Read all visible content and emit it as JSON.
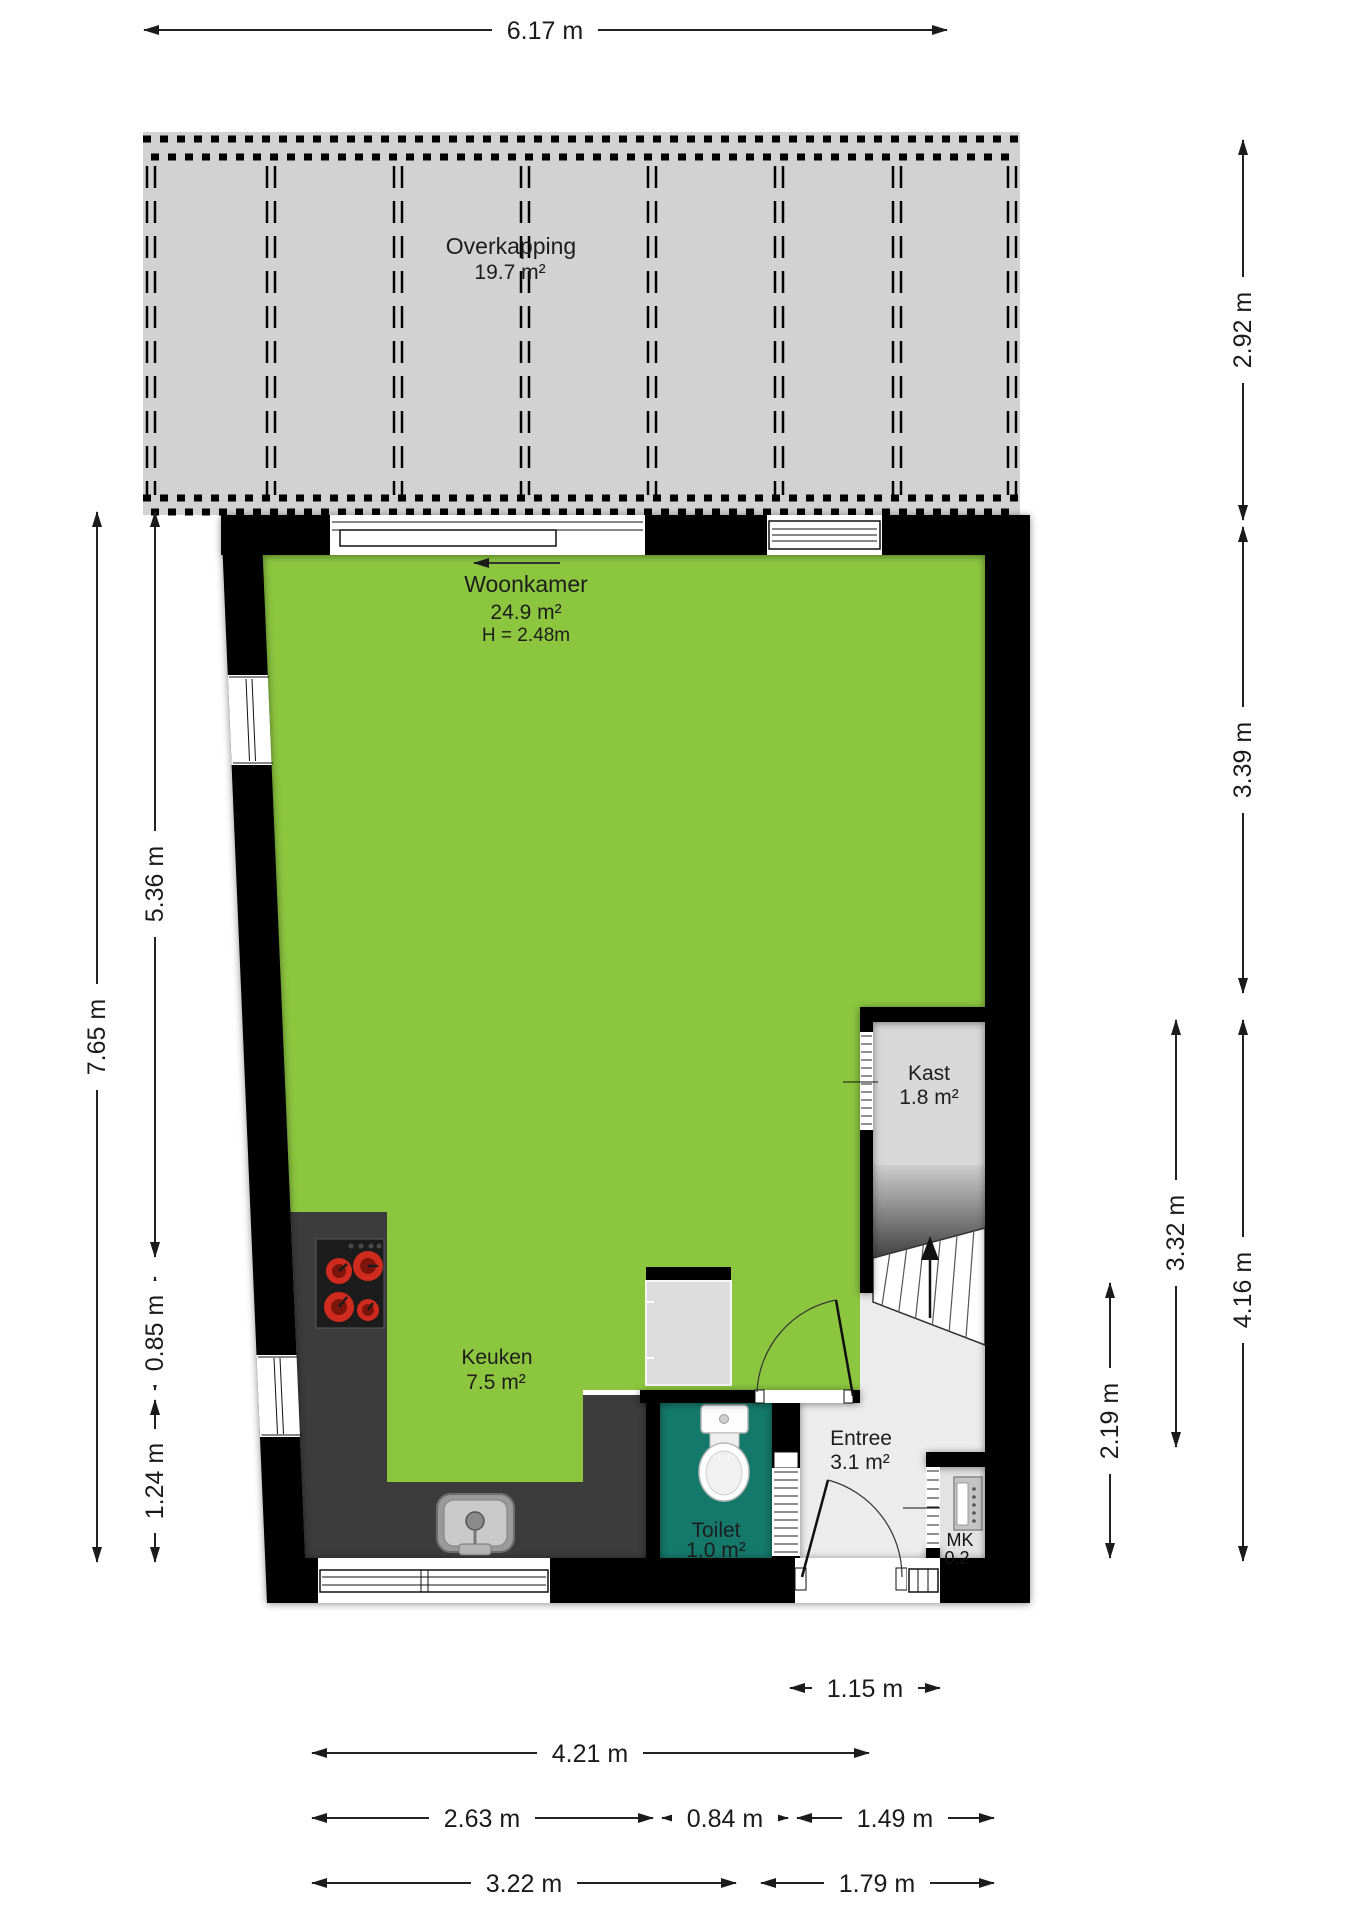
{
  "rooms": {
    "overkapping": {
      "label": "Overkapping",
      "area": "19.7 m²"
    },
    "woonkamer": {
      "label": "Woonkamer",
      "area": "24.9 m²",
      "height": "H = 2.48m"
    },
    "kast": {
      "label": "Kast",
      "area": "1.8 m²"
    },
    "keuken": {
      "label": "Keuken",
      "area": "7.5 m²"
    },
    "toilet": {
      "label": "Toilet",
      "area": "1.0 m²"
    },
    "entree": {
      "label": "Entree",
      "area": "3.1 m²"
    },
    "meterkast": {
      "label": "MK",
      "area": "0.2"
    }
  },
  "dimensions": {
    "top_width": "6.17 m",
    "left_total": "7.65 m",
    "left_upper": "5.36 m",
    "left_window": "0.85 m",
    "left_lower": "1.24 m",
    "right_overkapping": "2.92 m",
    "right_woonkamer": "3.39 m",
    "right_stairs": "3.32 m",
    "right_lower": "4.16 m",
    "right_entree": "2.19 m",
    "bottom_door": "1.15 m",
    "bottom_total": "4.21 m",
    "bottom_keuken": "2.63 m",
    "bottom_toilet": "0.84 m",
    "bottom_entree": "1.49 m",
    "bottom_left": "3.22 m",
    "bottom_right": "1.79 m"
  },
  "colors": {
    "living": "#8cc63f",
    "toilet": "#14796a",
    "canopy": "#d2d2d2",
    "closet": "#d8d8d8",
    "hall": "#ececec",
    "mk_floor": "#e3e3e3",
    "counter": "#3c3c3c",
    "wall": "#000000",
    "burner": "#cf2b1e"
  }
}
